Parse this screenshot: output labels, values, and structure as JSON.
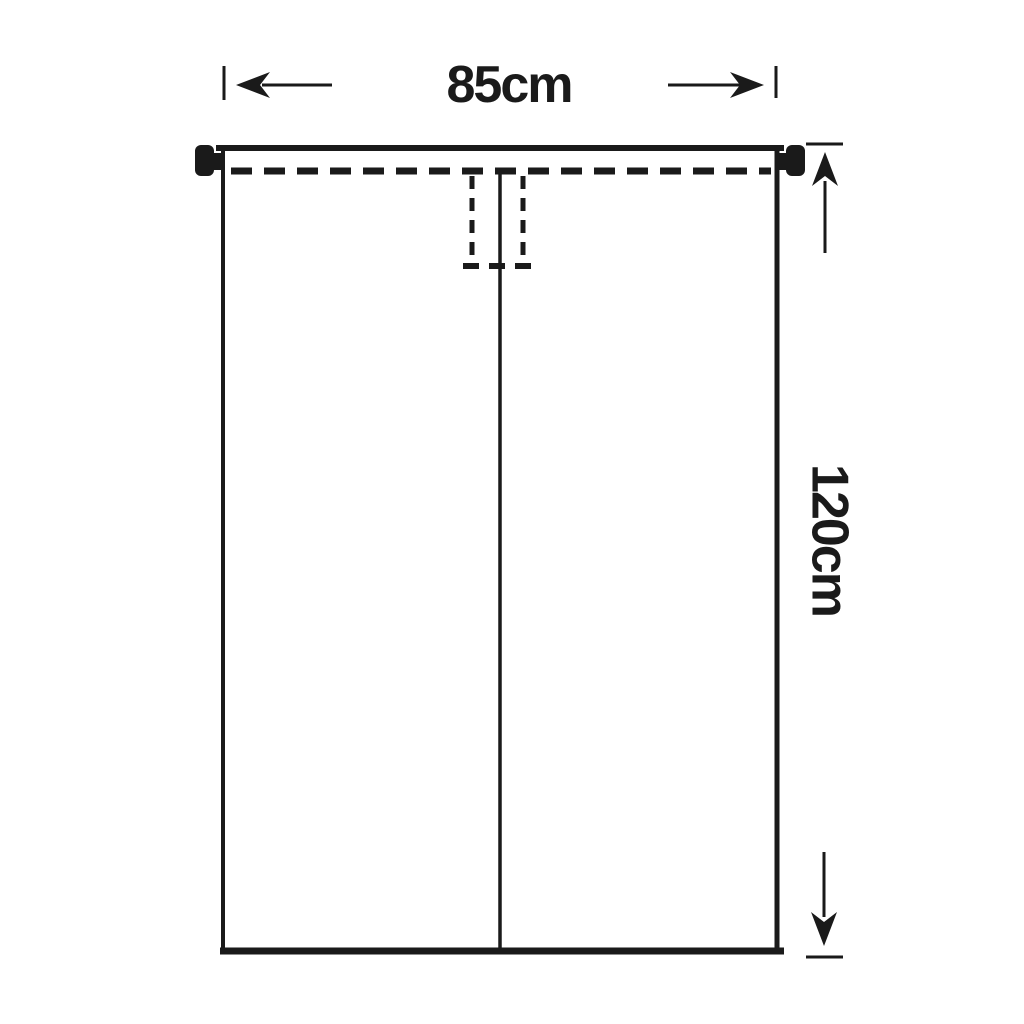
{
  "diagram": {
    "width_label": "85cm",
    "height_label": "120cm",
    "colors": {
      "line": "#1a1a1a",
      "background": "#ffffff"
    }
  }
}
